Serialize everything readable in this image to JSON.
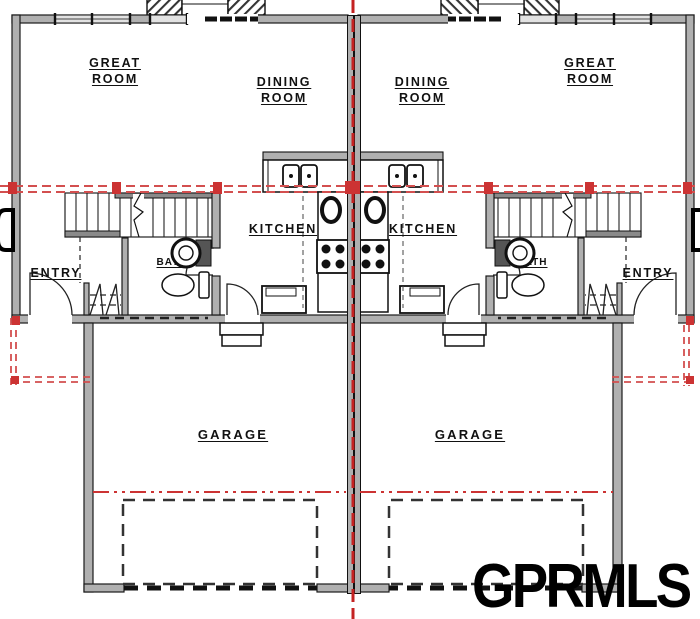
{
  "page": {
    "width": 700,
    "height": 619,
    "background": "#ffffff",
    "description_of_view": "duplex main floor plan, two mirrored units"
  },
  "watermark": {
    "text": "GPRMLS"
  },
  "colors": {
    "wall_fill": "#b0b0b0",
    "line": "#1a1a1a",
    "window_fill": "#e2e2e2",
    "red_overlay": "#d34f4f",
    "red_centerline": "#c42222",
    "red_marker": "#cc3333"
  },
  "rooms": [
    {
      "id": "great-room-left",
      "lines": [
        "GREAT",
        "ROOM"
      ]
    },
    {
      "id": "dining-room-left",
      "lines": [
        "DINING",
        "ROOM"
      ]
    },
    {
      "id": "dining-room-right",
      "lines": [
        "DINING",
        "ROOM"
      ]
    },
    {
      "id": "great-room-right",
      "lines": [
        "GREAT",
        "ROOM"
      ]
    },
    {
      "id": "kitchen-left",
      "lines": [
        "KITCHEN"
      ]
    },
    {
      "id": "kitchen-right",
      "lines": [
        "KITCHEN"
      ]
    },
    {
      "id": "entry-left",
      "lines": [
        "ENTRY"
      ]
    },
    {
      "id": "entry-right",
      "lines": [
        "ENTRY"
      ]
    },
    {
      "id": "bath-left",
      "lines": [
        "BATH"
      ]
    },
    {
      "id": "bath-right",
      "lines": [
        "BATH"
      ]
    },
    {
      "id": "garage-left",
      "lines": [
        "GARAGE"
      ]
    },
    {
      "id": "garage-right",
      "lines": [
        "GARAGE"
      ]
    }
  ]
}
